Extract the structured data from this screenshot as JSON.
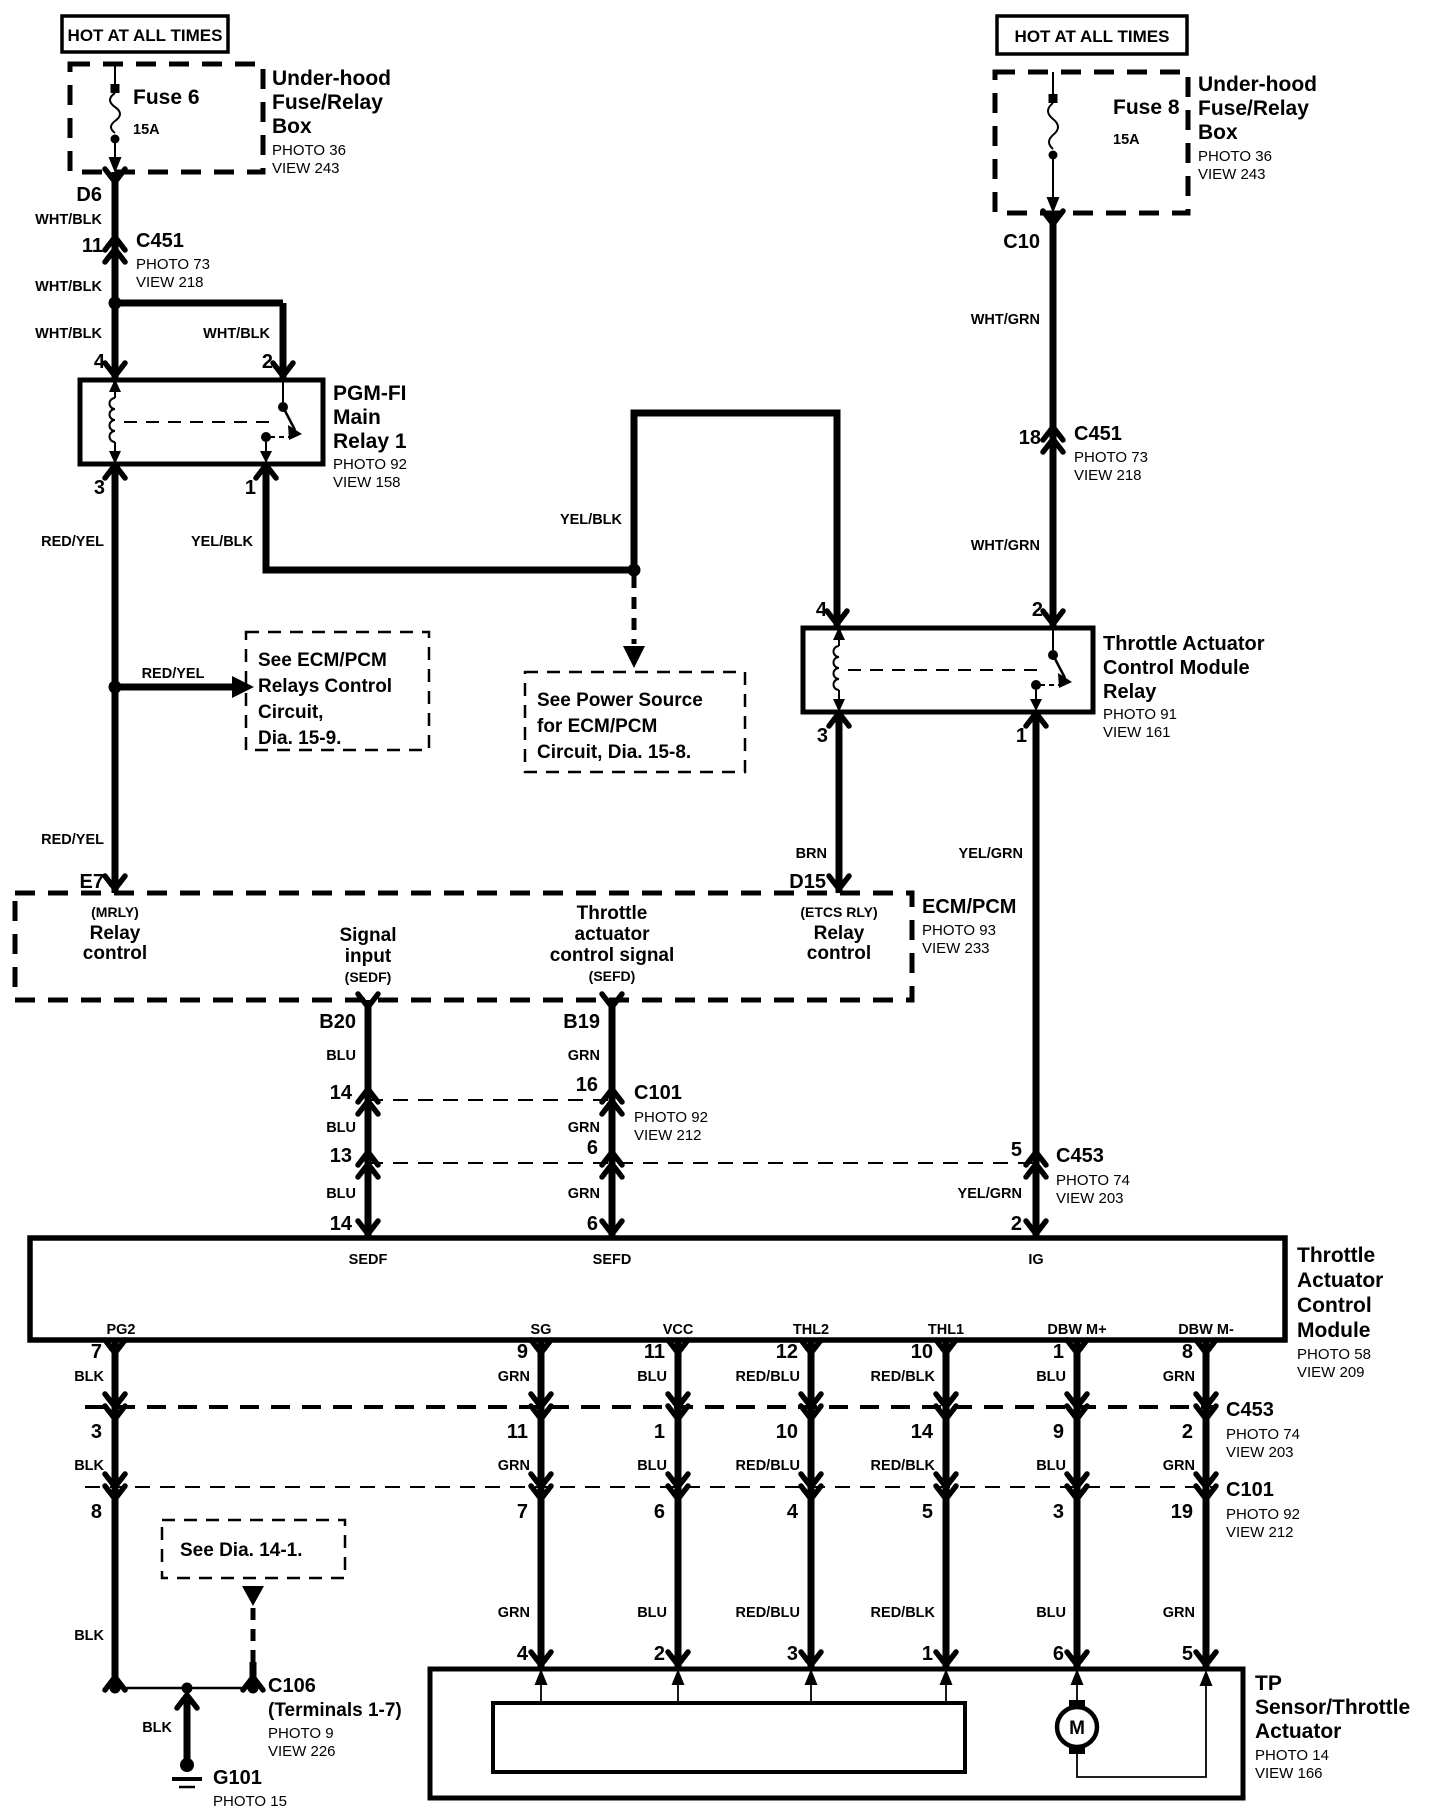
{
  "colors": {
    "ink": "#000000",
    "bg": "#ffffff"
  },
  "tl": {
    "hot": "HOT AT ALL TIMES",
    "fuse": "Fuse 6",
    "amp": "15A",
    "box1": "Under-hood",
    "box2": "Fuse/Relay",
    "box3": "Box",
    "boxr1": "PHOTO 36",
    "boxr2": "VIEW 243",
    "d6": "D6",
    "w1": "WHT/BLK",
    "c451pin": "11",
    "c451": "C451",
    "c451r1": "PHOTO 73",
    "c451r2": "VIEW 218",
    "w2": "WHT/BLK",
    "w3": "WHT/BLK",
    "w4": "WHT/BLK",
    "p4": "4",
    "p2": "2",
    "p3": "3",
    "p1": "1",
    "r1": "PGM-FI",
    "r2": "Main",
    "r3": "Relay 1",
    "rr1": "PHOTO 92",
    "rr2": "VIEW 158",
    "w5": "RED/YEL",
    "w6": "YEL/BLK",
    "w7": "RED/YEL",
    "w8": "RED/YEL",
    "e7": "E7",
    "see1": [
      "See ECM/PCM",
      "Relays Control",
      "Circuit,",
      "Dia. 15-9."
    ],
    "w9": "YEL/BLK",
    "see2": [
      "See Power Source",
      "for ECM/PCM",
      "Circuit, Dia. 15-8."
    ]
  },
  "tr": {
    "hot": "HOT AT ALL TIMES",
    "fuse": "Fuse 8",
    "amp": "15A",
    "box1": "Under-hood",
    "box2": "Fuse/Relay",
    "box3": "Box",
    "boxr1": "PHOTO 36",
    "boxr2": "VIEW 243",
    "c10": "C10",
    "w1": "WHT/GRN",
    "c451pin": "18",
    "c451": "C451",
    "c451r1": "PHOTO 73",
    "c451r2": "VIEW 218",
    "w2": "WHT/GRN",
    "p4": "4",
    "p2": "2",
    "p3": "3",
    "p1": "1",
    "r1": "Throttle Actuator",
    "r2": "Control Module",
    "r3": "Relay",
    "rr1": "PHOTO 91",
    "rr2": "VIEW 161",
    "w3": "BRN",
    "w4": "YEL/GRN",
    "d15": "D15"
  },
  "ecm": {
    "mrly": "(MRLY)",
    "mrly2": "Relay",
    "mrly3": "control",
    "sig1": "Signal",
    "sig2": "input",
    "sig3": "(SEDF)",
    "tac1": "Throttle",
    "tac2": "actuator",
    "tac3": "control signal",
    "tac4": "(SEFD)",
    "etcs": "(ETCS RLY)",
    "etcs2": "Relay",
    "etcs3": "control",
    "name": "ECM/PCM",
    "r1": "PHOTO 93",
    "r2": "VIEW 233",
    "b20": "B20",
    "b19": "B19"
  },
  "link": {
    "blu1": "BLU",
    "blu2": "BLU",
    "blu3": "BLU",
    "grn1": "GRN",
    "grn2": "GRN",
    "grn3": "GRN",
    "n14a": "14",
    "n16": "16",
    "n13": "13",
    "n6a": "6",
    "n14b": "14",
    "n6b": "6",
    "c101": "C101",
    "c101r1": "PHOTO 92",
    "c101r2": "VIEW 212",
    "c453": "C453",
    "c453r1": "PHOTO 74",
    "c453r2": "VIEW 203",
    "n5": "5",
    "n2": "2",
    "yg": "YEL/GRN"
  },
  "mod": {
    "sedf": "SEDF",
    "sefd": "SEFD",
    "ig": "IG",
    "pg2": "PG2",
    "sg": "SG",
    "vcc": "VCC",
    "thl2": "THL2",
    "thl1": "THL1",
    "dbwp": "DBW M+",
    "dbwm": "DBW M-",
    "n1": "Throttle",
    "n2": "Actuator",
    "n3": "Control",
    "n4": "Module",
    "r1": "PHOTO 58",
    "r2": "VIEW 209"
  },
  "grid": {
    "cols": [
      {
        "n1": "7",
        "c1": "BLK",
        "n2": "3",
        "c2": "BLK",
        "n3": "8"
      },
      {
        "n1": "9",
        "c1": "GRN",
        "n2": "11",
        "c2": "GRN",
        "n3": "7",
        "c3": "GRN",
        "n4": "4"
      },
      {
        "n1": "11",
        "c1": "BLU",
        "n2": "1",
        "c2": "BLU",
        "n3": "6",
        "c3": "BLU",
        "n4": "2"
      },
      {
        "n1": "12",
        "c1": "RED/BLU",
        "n2": "10",
        "c2": "RED/BLU",
        "n3": "4",
        "c3": "RED/BLU",
        "n4": "3"
      },
      {
        "n1": "10",
        "c1": "RED/BLK",
        "n2": "14",
        "c2": "RED/BLK",
        "n3": "5",
        "c3": "RED/BLK",
        "n4": "1"
      },
      {
        "n1": "1",
        "c1": "BLU",
        "n2": "9",
        "c2": "BLU",
        "n3": "3",
        "c3": "BLU",
        "n4": "6"
      },
      {
        "n1": "8",
        "c1": "GRN",
        "n2": "2",
        "c2": "GRN",
        "n3": "19",
        "c3": "GRN",
        "n4": "5"
      }
    ],
    "c453": "C453",
    "c453r1": "PHOTO 74",
    "c453r2": "VIEW 203",
    "c101": "C101",
    "c101r1": "PHOTO 92",
    "c101r2": "VIEW 212",
    "see3": "See Dia. 14-1.",
    "blk": "BLK"
  },
  "tp": {
    "m": "M",
    "n1": "TP",
    "n2": "Sensor/Throttle",
    "n3": "Actuator",
    "r1": "PHOTO 14",
    "r2": "VIEW 166"
  },
  "gnd": {
    "c106": "C106",
    "c106b": "(Terminals 1-7)",
    "c106r1": "PHOTO 9",
    "c106r2": "VIEW 226",
    "blk": "BLK",
    "g101": "G101",
    "g101r": "PHOTO 15"
  }
}
